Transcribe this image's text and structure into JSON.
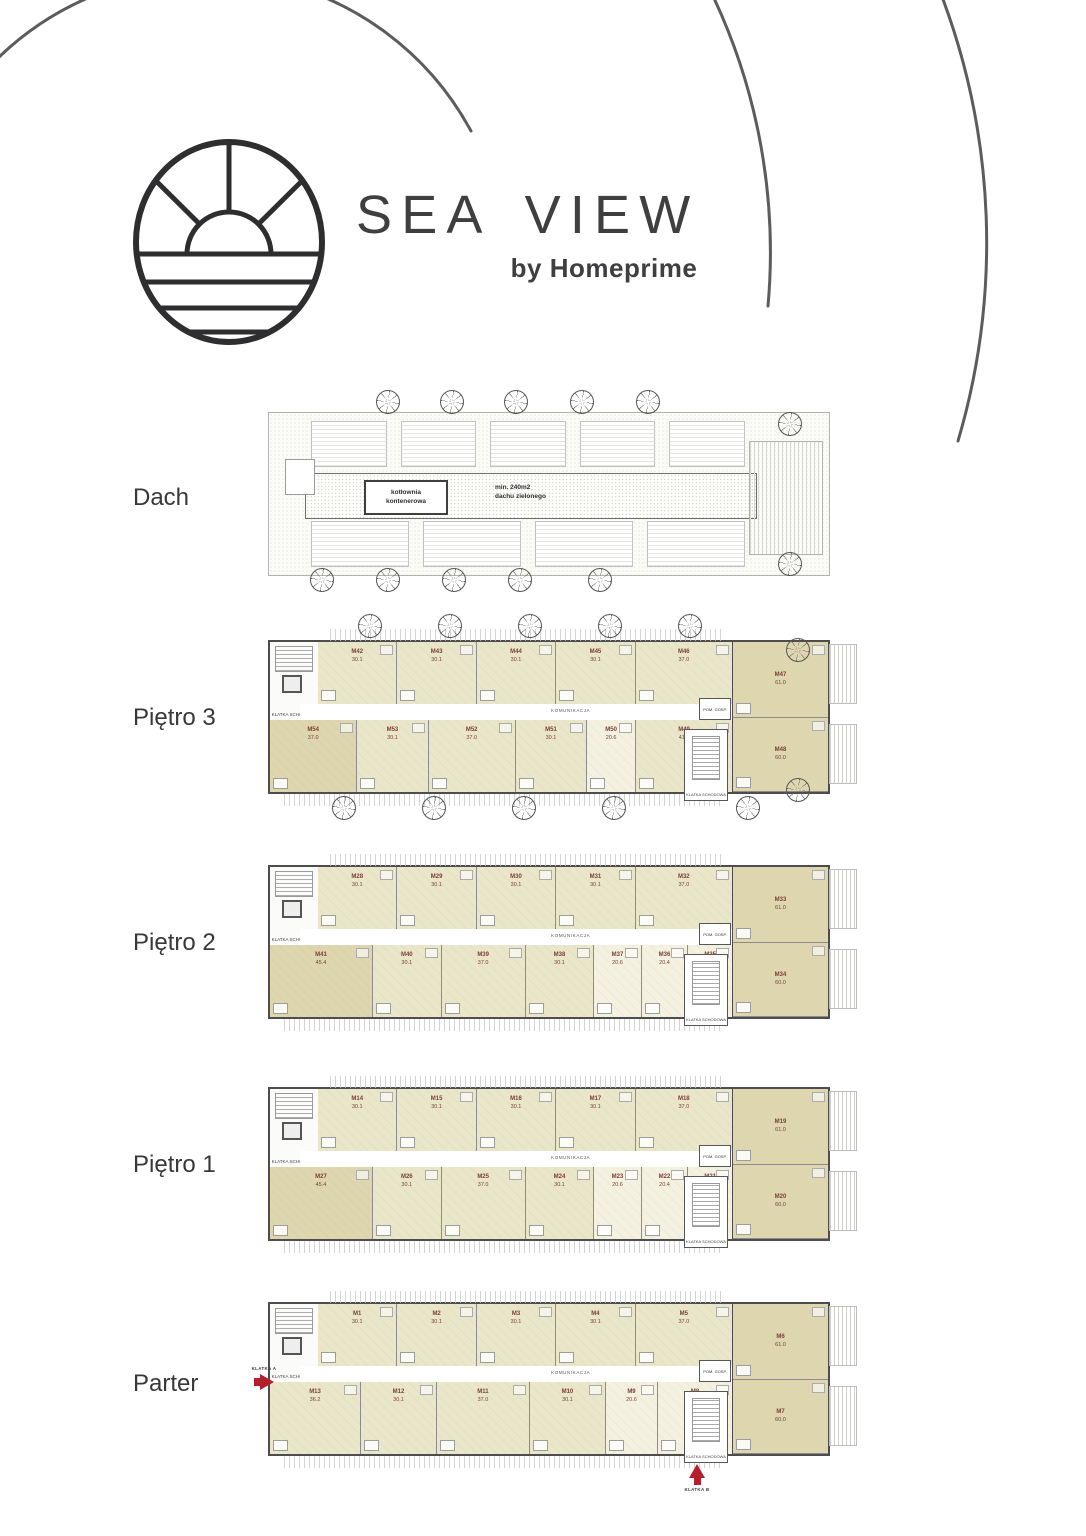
{
  "brand": {
    "title": "SEA VIEW",
    "subtitle": "by Homeprime",
    "logo": "sun-over-sea-icon"
  },
  "colors": {
    "wall": "#4d4d4d",
    "unit_fill": "#eae6c9",
    "unit_fill_dark": "#ddd6ae",
    "unit_fill_pale": "#f4f1e1",
    "unit_label": "#7b4038",
    "accent_red": "#b51f2b",
    "text": "#3b3b3d"
  },
  "roof": {
    "label": "Dach",
    "boiler_line1": "kotłownia",
    "boiler_line2": "kontenerowa",
    "green_line1": "min. 240m2",
    "green_line2": "dachu zielonego"
  },
  "small_labels": {
    "stairwell": "KLATKA SCHODOWA",
    "corridor": "KOMUNIKACJA",
    "utility": "POM. GOSP.",
    "entry_a": "KLATKA A",
    "entry_b": "KLATKA B"
  },
  "floors": [
    {
      "id": "pietro3",
      "label": "Piętro 3",
      "top_units": [
        {
          "id": "M42",
          "area": "30.1"
        },
        {
          "id": "M43",
          "area": "30.1"
        },
        {
          "id": "M44",
          "area": "30.1"
        },
        {
          "id": "M45",
          "area": "30.1"
        },
        {
          "id": "M46",
          "area": "37.0"
        }
      ],
      "right_units": [
        {
          "id": "M47",
          "area": "61.0",
          "cls": "hl"
        },
        {
          "id": "M48",
          "area": "60.0",
          "cls": "hl"
        }
      ],
      "bottom_units": [
        {
          "id": "M54",
          "area": "37.0",
          "cls": "hl"
        },
        {
          "id": "M53",
          "area": "30.1"
        },
        {
          "id": "M52",
          "area": "37.0"
        },
        {
          "id": "M51",
          "area": "30.1"
        },
        {
          "id": "M50",
          "area": "20.6",
          "cls": "pale"
        },
        {
          "id": "M49",
          "area": "41.1"
        }
      ]
    },
    {
      "id": "pietro2",
      "label": "Piętro 2",
      "top_units": [
        {
          "id": "M28",
          "area": "30.1"
        },
        {
          "id": "M29",
          "area": "30.1"
        },
        {
          "id": "M30",
          "area": "30.1"
        },
        {
          "id": "M31",
          "area": "30.1"
        },
        {
          "id": "M32",
          "area": "37.0"
        }
      ],
      "right_units": [
        {
          "id": "M33",
          "area": "61.0",
          "cls": "hl"
        },
        {
          "id": "M34",
          "area": "60.0",
          "cls": "hl"
        }
      ],
      "bottom_units": [
        {
          "id": "M41",
          "area": "45.4",
          "cls": "hl"
        },
        {
          "id": "M40",
          "area": "30.1"
        },
        {
          "id": "M39",
          "area": "37.0"
        },
        {
          "id": "M38",
          "area": "30.1"
        },
        {
          "id": "M37",
          "area": "20.6",
          "cls": "pale"
        },
        {
          "id": "M36",
          "area": "20.4",
          "cls": "pale"
        },
        {
          "id": "M35",
          "area": "19.4",
          "cls": "pale"
        }
      ]
    },
    {
      "id": "pietro1",
      "label": "Piętro 1",
      "top_units": [
        {
          "id": "M14",
          "area": "30.1"
        },
        {
          "id": "M15",
          "area": "30.1"
        },
        {
          "id": "M16",
          "area": "30.1"
        },
        {
          "id": "M17",
          "area": "30.1"
        },
        {
          "id": "M18",
          "area": "37.0"
        }
      ],
      "right_units": [
        {
          "id": "M19",
          "area": "61.0",
          "cls": "hl"
        },
        {
          "id": "M20",
          "area": "60.0",
          "cls": "hl"
        }
      ],
      "bottom_units": [
        {
          "id": "M27",
          "area": "45.4",
          "cls": "hl"
        },
        {
          "id": "M26",
          "area": "30.1"
        },
        {
          "id": "M25",
          "area": "37.0"
        },
        {
          "id": "M24",
          "area": "30.1"
        },
        {
          "id": "M23",
          "area": "20.6",
          "cls": "pale"
        },
        {
          "id": "M22",
          "area": "20.4",
          "cls": "pale"
        },
        {
          "id": "M21",
          "area": "19.4",
          "cls": "pale"
        }
      ]
    },
    {
      "id": "parter",
      "label": "Parter",
      "top_units": [
        {
          "id": "M1",
          "area": "30.1"
        },
        {
          "id": "M2",
          "area": "30.1"
        },
        {
          "id": "M3",
          "area": "30.1"
        },
        {
          "id": "M4",
          "area": "30.1"
        },
        {
          "id": "M5",
          "area": "37.0"
        }
      ],
      "right_units": [
        {
          "id": "M6",
          "area": "61.0",
          "cls": "hl"
        },
        {
          "id": "M7",
          "area": "60.0",
          "cls": "hl"
        }
      ],
      "bottom_units": [
        {
          "id": "M13",
          "area": "36.2"
        },
        {
          "id": "M12",
          "area": "30.1"
        },
        {
          "id": "M11",
          "area": "37.0"
        },
        {
          "id": "M10",
          "area": "30.1"
        },
        {
          "id": "M9",
          "area": "20.6",
          "cls": "pale"
        },
        {
          "id": "M8",
          "area": "29.7",
          "cls": "pale"
        }
      ]
    }
  ]
}
